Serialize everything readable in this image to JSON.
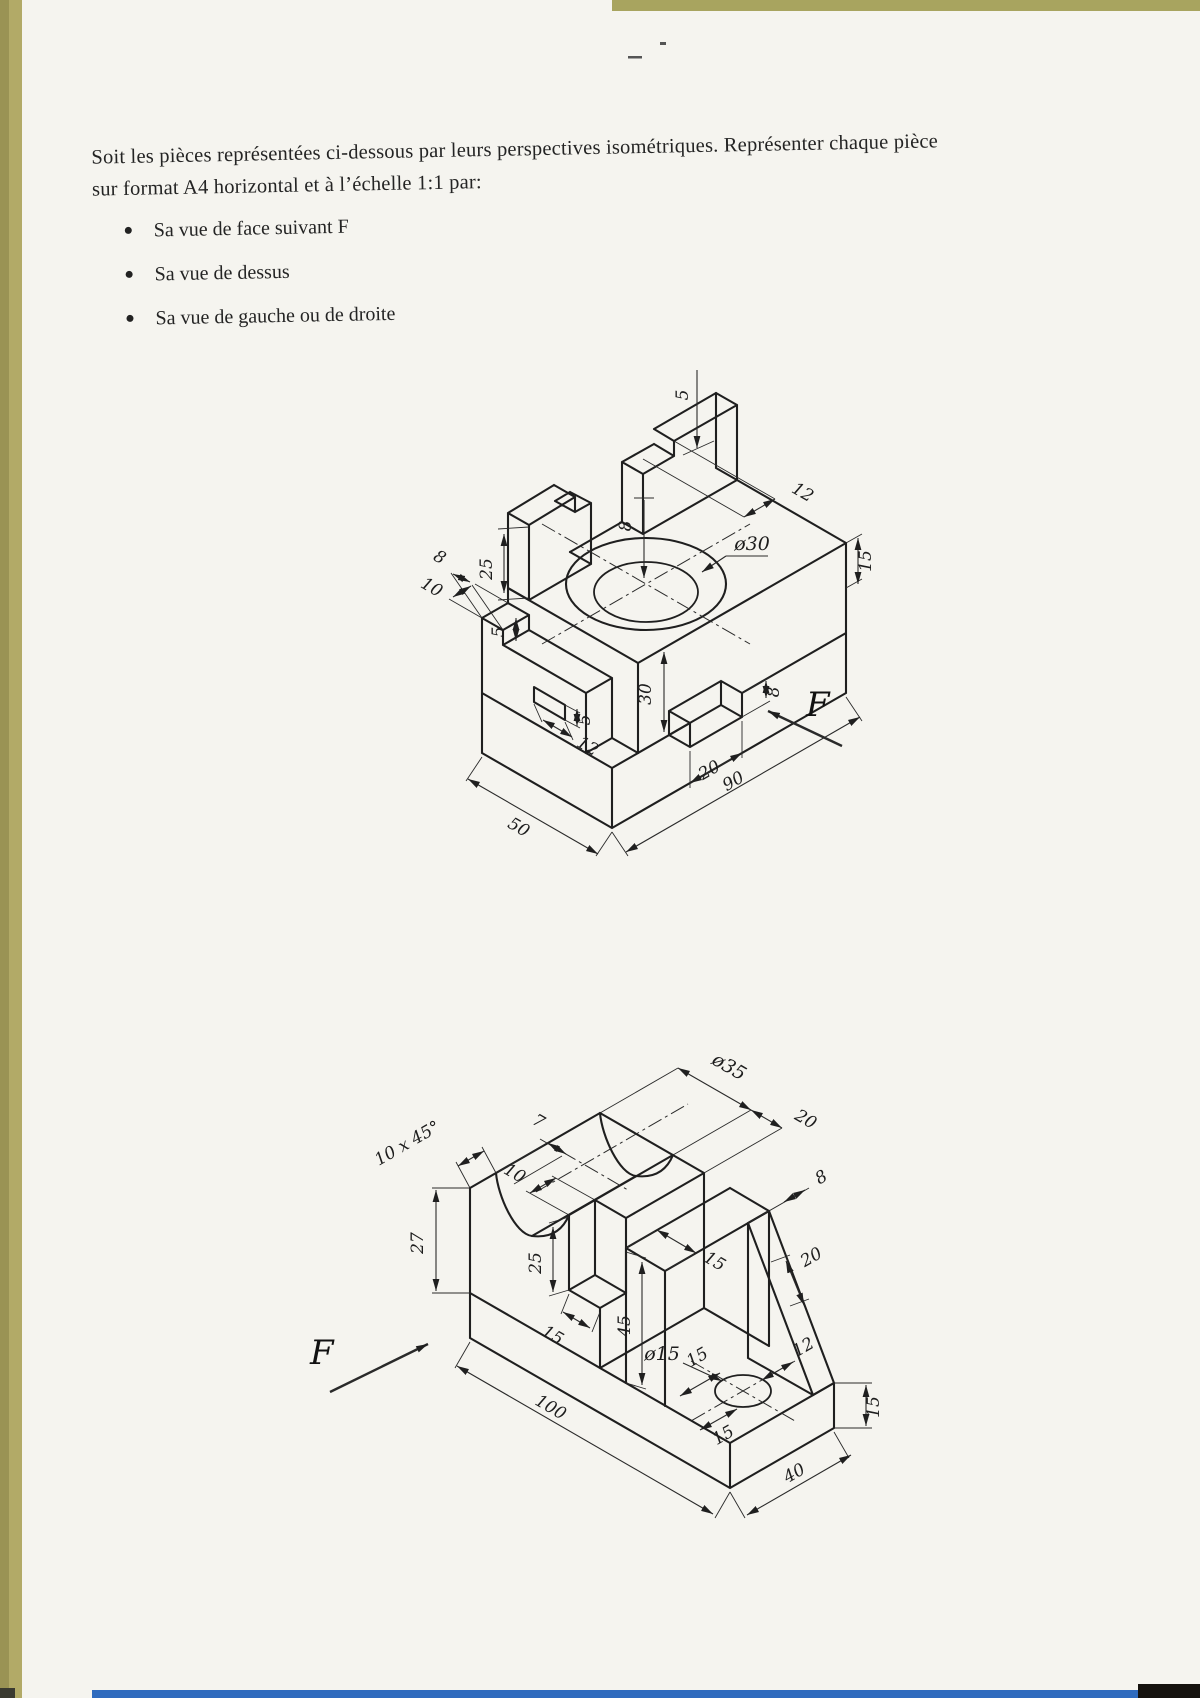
{
  "page": {
    "background": "#f5f4ef",
    "edge_strip": "#b2aa67",
    "bottom_line": "#2f6bbe"
  },
  "instructions": {
    "line1": "Soit les pièces représentées ci-dessous par leurs perspectives isométriques. Représenter chaque pièce",
    "line2": "sur format A4 horizontal et à l’échelle 1:1 par:",
    "bullets": [
      "Sa  vue de face suivant F",
      "Sa vue de dessus",
      "Sa vue de  gauche ou de droite"
    ]
  },
  "figure1": {
    "view_arrow": "F",
    "dims": {
      "post_height": "25",
      "post_notch_depth": "5",
      "post_notch_width": "12",
      "edge_height": "15",
      "bore_depth": "8",
      "bore_diameter": "ø30",
      "tab_width": "8",
      "wall_thickness": "10",
      "step_depth": "5",
      "slot_height": "5",
      "slot_length": "12",
      "body_height": "30",
      "notch_height": "8",
      "notch_length": "20",
      "length": "90",
      "width": "50"
    }
  },
  "figure2": {
    "view_arrow": "F",
    "dims": {
      "top_edge": "7",
      "chamfer": "10 x 45°",
      "groove_diameter": "ø35",
      "shoulder": "20",
      "notch_width": "10",
      "notch_depth": "25",
      "notch_length": "15",
      "pillar_height": "45",
      "pillar_top": "15",
      "pillar_side": "15",
      "rib_length": "20",
      "rib_thickness": "8",
      "hole_diameter": "ø15",
      "hole_to_edge": "12",
      "hole_to_front": "15",
      "left_height": "27",
      "length": "100",
      "width": "40",
      "base_height": "15"
    }
  }
}
